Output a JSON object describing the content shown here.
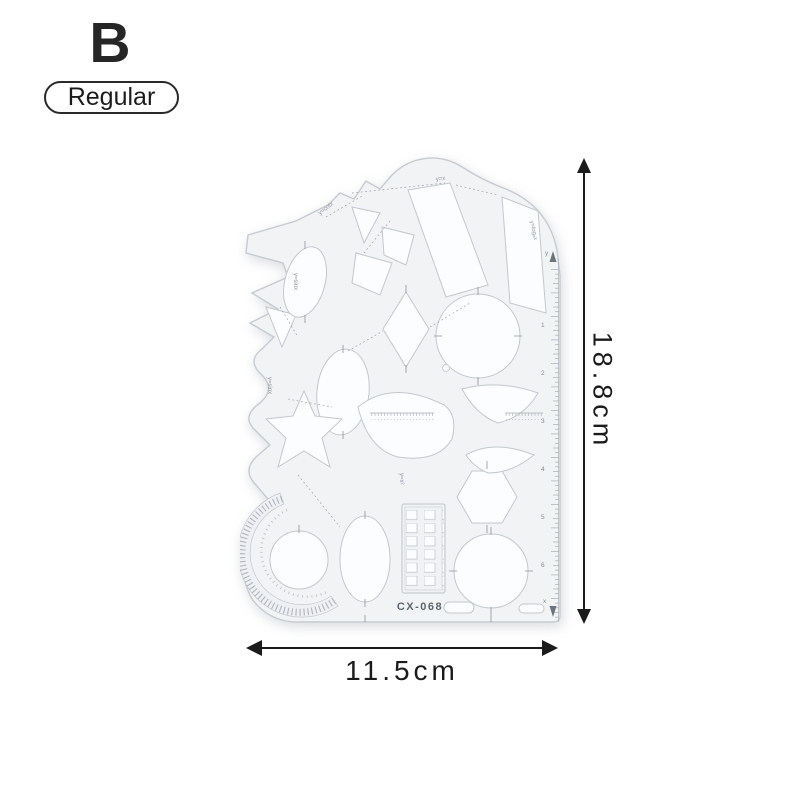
{
  "variant": {
    "letter": "B",
    "badge_label": "Regular"
  },
  "dimensions": {
    "height": "18.8cm",
    "width": "11.5cm"
  },
  "template": {
    "model_number": "CX-068",
    "curve_labels": [
      "y=x",
      "y=cotx",
      "y=logₐx",
      "y=sinx",
      "y=sinx",
      "y=x²"
    ],
    "ruler_numbers": [
      "1",
      "2",
      "3",
      "4",
      "5",
      "6"
    ],
    "axis_labels": [
      "y",
      "x"
    ]
  },
  "colors": {
    "background": "#ffffff",
    "annotation_ink": "#1b1b1b",
    "plastic_fill": "#f2f3f5",
    "plastic_edge": "#c6cbd1"
  }
}
